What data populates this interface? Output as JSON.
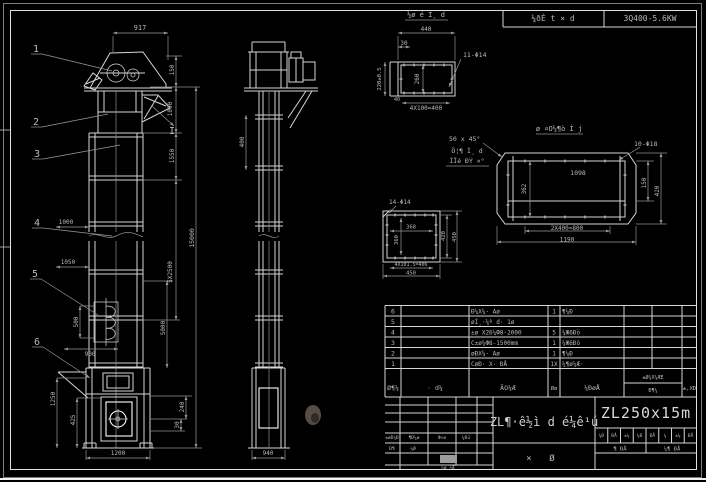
{
  "header": {
    "field1": "¼ðÈ t × d",
    "field2": "3Q400-5.6KW"
  },
  "front_view": {
    "balloons": {
      "b1": "1",
      "b2": "2",
      "b3": "3",
      "b4": "4",
      "b5": "5",
      "b6": "6"
    },
    "section_label": "I",
    "dims": {
      "top": "917",
      "right_a": "150",
      "right_b": "1090",
      "right_c": "1550",
      "right_mid": "5X2500",
      "right_inner": "5000",
      "overall": "15000",
      "left_a": "1000",
      "left_b": "1050",
      "bucket": "500",
      "spacing": "900",
      "boot_left_a": "1250",
      "boot_left_b": "425",
      "boot_right_a": "240",
      "boot_right_b": "30",
      "base": "1200"
    }
  },
  "side_view": {
    "dims": {
      "neck": "400",
      "base": "940"
    }
  },
  "detail_flange": {
    "title": "½ø é Ì¸ d",
    "hole_label": "11-Φ14",
    "dims": {
      "w": "440",
      "offset": "30",
      "h": "220±0.5",
      "inner": "260",
      "pitch": "4X100=400",
      "mark": "40"
    }
  },
  "detail_trough": {
    "title": "ø ¤O½¶ò Ì j",
    "chamfer": "50 x 45°",
    "hole_label": "10-Φ18",
    "dims": {
      "inner_w": "1098",
      "inner_h": "362",
      "right_a": "150",
      "right_b": "420",
      "pitch": "2X400=800",
      "w": "1190"
    }
  },
  "detail_square": {
    "hole_label": "14-Φ14",
    "dims": {
      "inner_w": "368",
      "inner_h": "360",
      "right_a": "420",
      "right_b": "450",
      "pitch": "4X101.5=406",
      "w": "450"
    }
  },
  "note": {
    "line1": "Ö¦¶ Ì¸ d",
    "line2": "ÍÏé ÐÝ ×°"
  },
  "bom": {
    "headers": {
      "no": "Ø¶¼",
      "code": "· d¼",
      "name": "ÃO¼Æ",
      "qty": "Øø",
      "mat": "¼ÐøÅ",
      "wt_top": "±Ø¼X¼ÆE",
      "wt_bot": "Ð¶¼",
      "note": "±,XÐ"
    },
    "rows": [
      {
        "no": "6",
        "name": "Ð¼X¼· Aø",
        "qty": "1",
        "mat": "¶¼Ð"
      },
      {
        "no": "5",
        "name": "øÌ¸·¼º d· 1ø",
        "qty": "",
        "mat": ""
      },
      {
        "no": "4",
        "name": "±ø X26¼Ф8-2000",
        "qty": "5",
        "mat": "¼Ж6Ðö"
      },
      {
        "no": "3",
        "name": "C±ø¼Ф8-1500mm",
        "qty": "1",
        "mat": "¼Ж6Ðö"
      },
      {
        "no": "2",
        "name": "øÐX¼· Aø",
        "qty": "1",
        "mat": "¶¼Ð"
      },
      {
        "no": "1",
        "name": "CøÐ· X· ÐÅ",
        "qty": "1X",
        "mat": "¼¶ø¼Æ·"
      }
    ]
  },
  "title_block": {
    "model": "ZL250x15m",
    "title": "ZL¶·ê½ì d é¼ê¹ú",
    "sub1": "×",
    "sub2": "Ø",
    "rev": {
      "l1": "±øÐ¼Ð",
      "l2": "¶Ð¼ø",
      "l3": "Ф×ø",
      "l4": "¼Ðü",
      "r1": "Ð¶",
      "r2": "¼Ø",
      "bottom": "¼ø ¼Æ"
    },
    "right": {
      "cells": [
        "¼Ð",
        "ÐÅ",
        "±¼",
        "¼Ð",
        "ÐÅ",
        "¼",
        "±¼",
        "ÐÅ"
      ],
      "row2a": "¶ ÐÅ",
      "row2b": "¼¶ ÐÅ"
    }
  }
}
